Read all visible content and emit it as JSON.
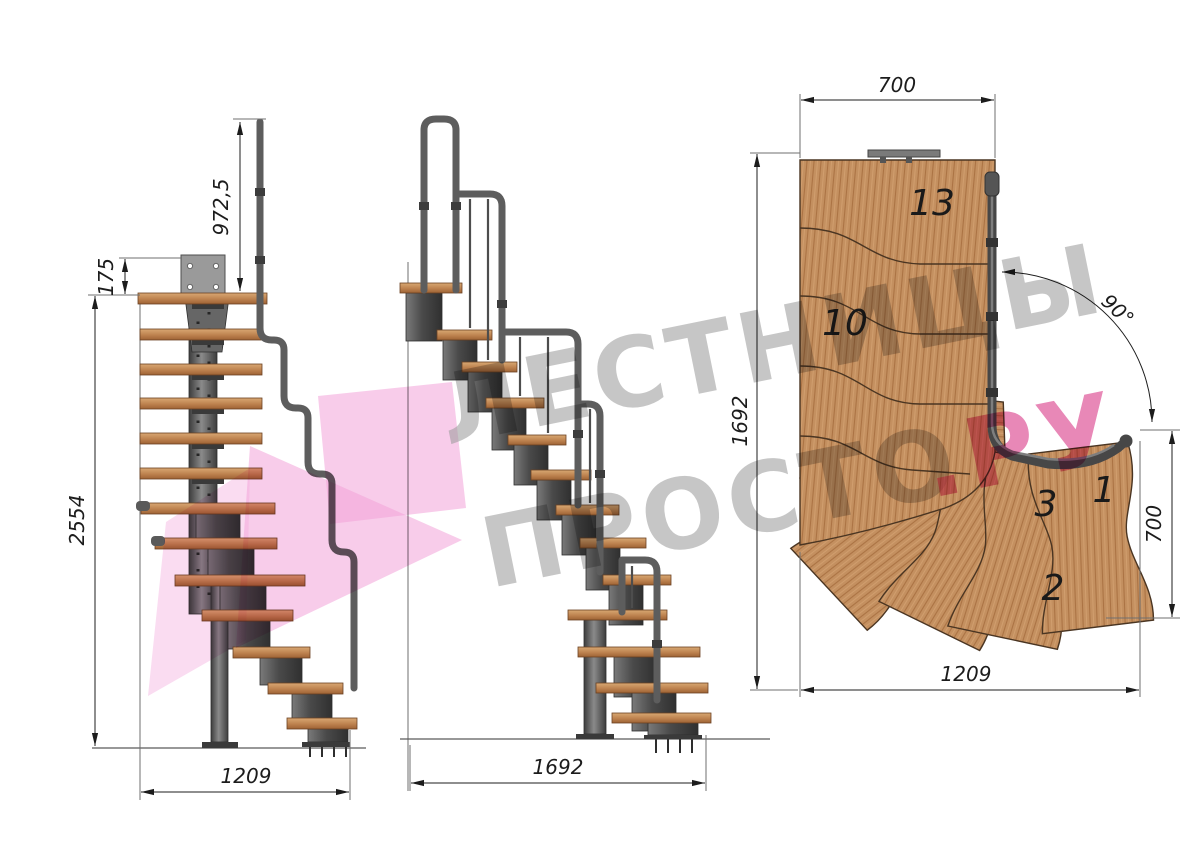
{
  "views": {
    "front": {
      "dims": {
        "rail_height": "972,5",
        "plate_offset": "175",
        "total_height": "2554",
        "width": "1209"
      }
    },
    "side": {
      "dims": {
        "length": "1692"
      }
    },
    "plan": {
      "dims": {
        "top_width": "700",
        "left_depth": "1692",
        "right_height": "700",
        "bottom_width": "1209",
        "angle": "90°"
      },
      "steps": {
        "n13": "13",
        "n10": "10",
        "n3": "3",
        "n1": "1",
        "n2": "2"
      }
    }
  },
  "watermark": {
    "line1": "ЛЕСТНИЦЫ",
    "line2": "ПРОСТО",
    "suffix": ".РУ"
  },
  "colors": {
    "wood_front": "#c08552",
    "wood_plan": "#c49060",
    "metal": "#4a4a4a",
    "dimension_text": "#1c1c1c",
    "watermark_gray": "#9e9e9e",
    "watermark_pink": "#df5a9b",
    "logo_pink": "#f2a3d9"
  }
}
